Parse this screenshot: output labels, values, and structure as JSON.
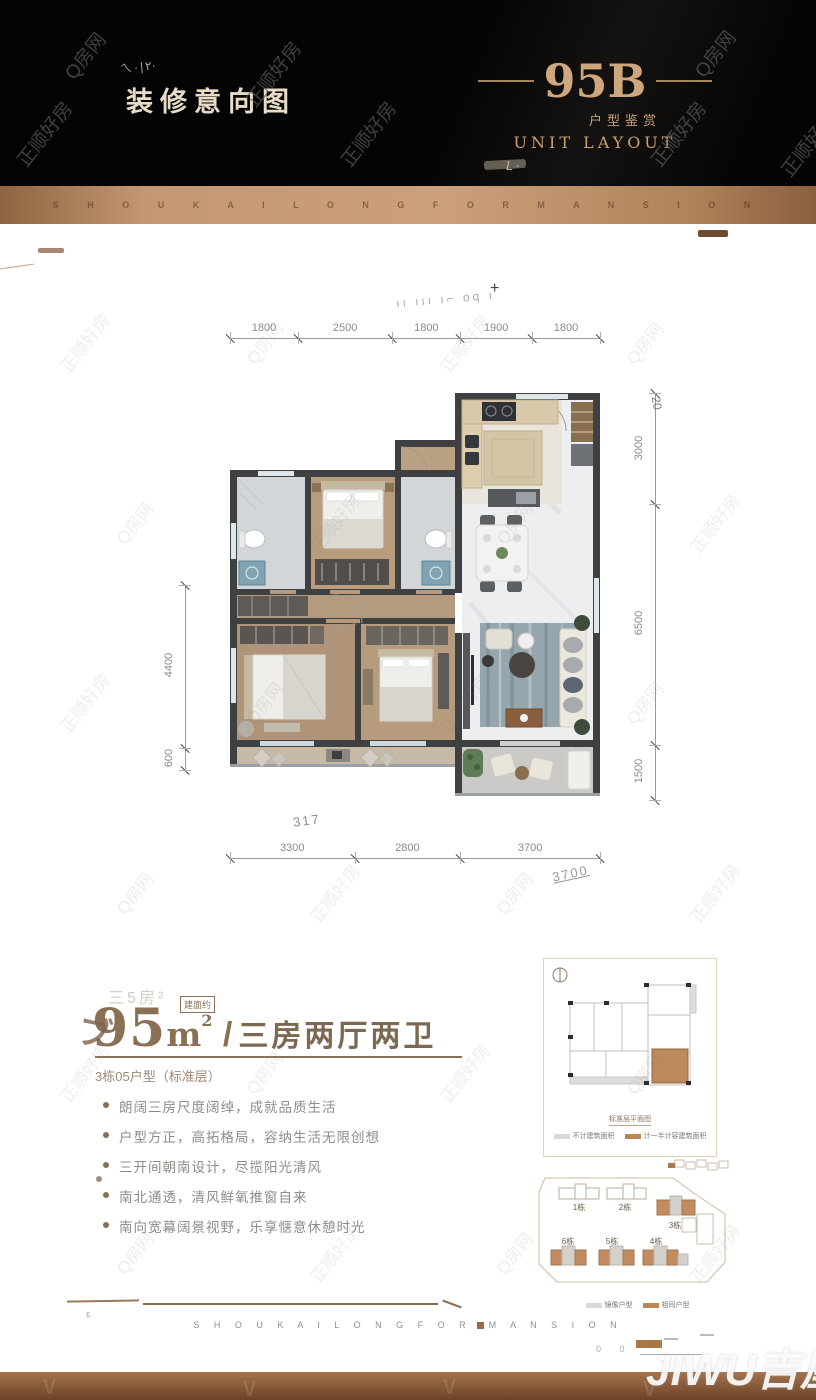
{
  "header": {
    "left_title": "装修意向图",
    "left_scrawl": "ㄟ·|٢·",
    "unit_code": "95B",
    "subtitle_cn": "户型鉴赏",
    "subtitle_en": "UNIT LAYOUT",
    "smudge_mark": "L·"
  },
  "brand": {
    "top": "S H O U K A I L O N G F O R M A N S I O N",
    "bottom_left": "S H O U K A I L O N G F O R",
    "bottom_right": "M A N S I O N"
  },
  "watermarks": {
    "primary": "正顺好房",
    "secondary": "Q房网",
    "corner_logo": "JIWU吉屋"
  },
  "plan": {
    "dims_top": [
      "1800",
      "2500",
      "1800",
      "1900",
      "1800"
    ],
    "dims_bottom": [
      "3300",
      "2800",
      "3700"
    ],
    "dims_right": [
      "3000",
      "6500",
      "1500"
    ],
    "dims_left": [
      "4400",
      "600"
    ],
    "scribbles": {
      "top": "ıı ııı ı⌐ oq ı",
      "cross": "+",
      "right_rotated": "20",
      "bottom_left": "317",
      "bottom_right": "3700",
      "corner": "ɛ",
      "zeros": "0  0"
    }
  },
  "info": {
    "area_badge": "建面约",
    "area_number": "95",
    "area_unit_letter": "m",
    "area_sup": "2",
    "ghost_text": "三5房²",
    "lead_mark": "ブ",
    "divider": "/",
    "layout_text": "三房两厅两卫",
    "unit_line": "3栋05户型（标准层）",
    "bullets": [
      "朗阔三房尺度阔绰，成就品质生活",
      "户型方正，高拓格局，容纳生活无限创想",
      "三开间朝南设计，尽揽阳光清风",
      "南北通透，清风鲜氧推窗自来",
      "南向宽幕阔景视野，乐享惬意休憩时光"
    ]
  },
  "thumb": {
    "caption": "标准层平面图",
    "legend": [
      {
        "label": "不计建筑面积",
        "color": "#d9d9d9"
      },
      {
        "label": "计一半计容建筑面积",
        "color": "#bb8757"
      }
    ]
  },
  "site_plan": {
    "buildings": [
      "1栋",
      "2栋",
      "3栋",
      "6栋",
      "5栋",
      "4栋"
    ],
    "legend": [
      {
        "label": "镜像户型",
        "color": "#d9d9d9"
      },
      {
        "label": "相同户型",
        "color": "#bb8757"
      }
    ]
  },
  "colors": {
    "accent_gold": "#c9a176",
    "title_brown": "#8a7055",
    "band_bronze": "#bb8a63",
    "band_dark": "#6b4226"
  }
}
